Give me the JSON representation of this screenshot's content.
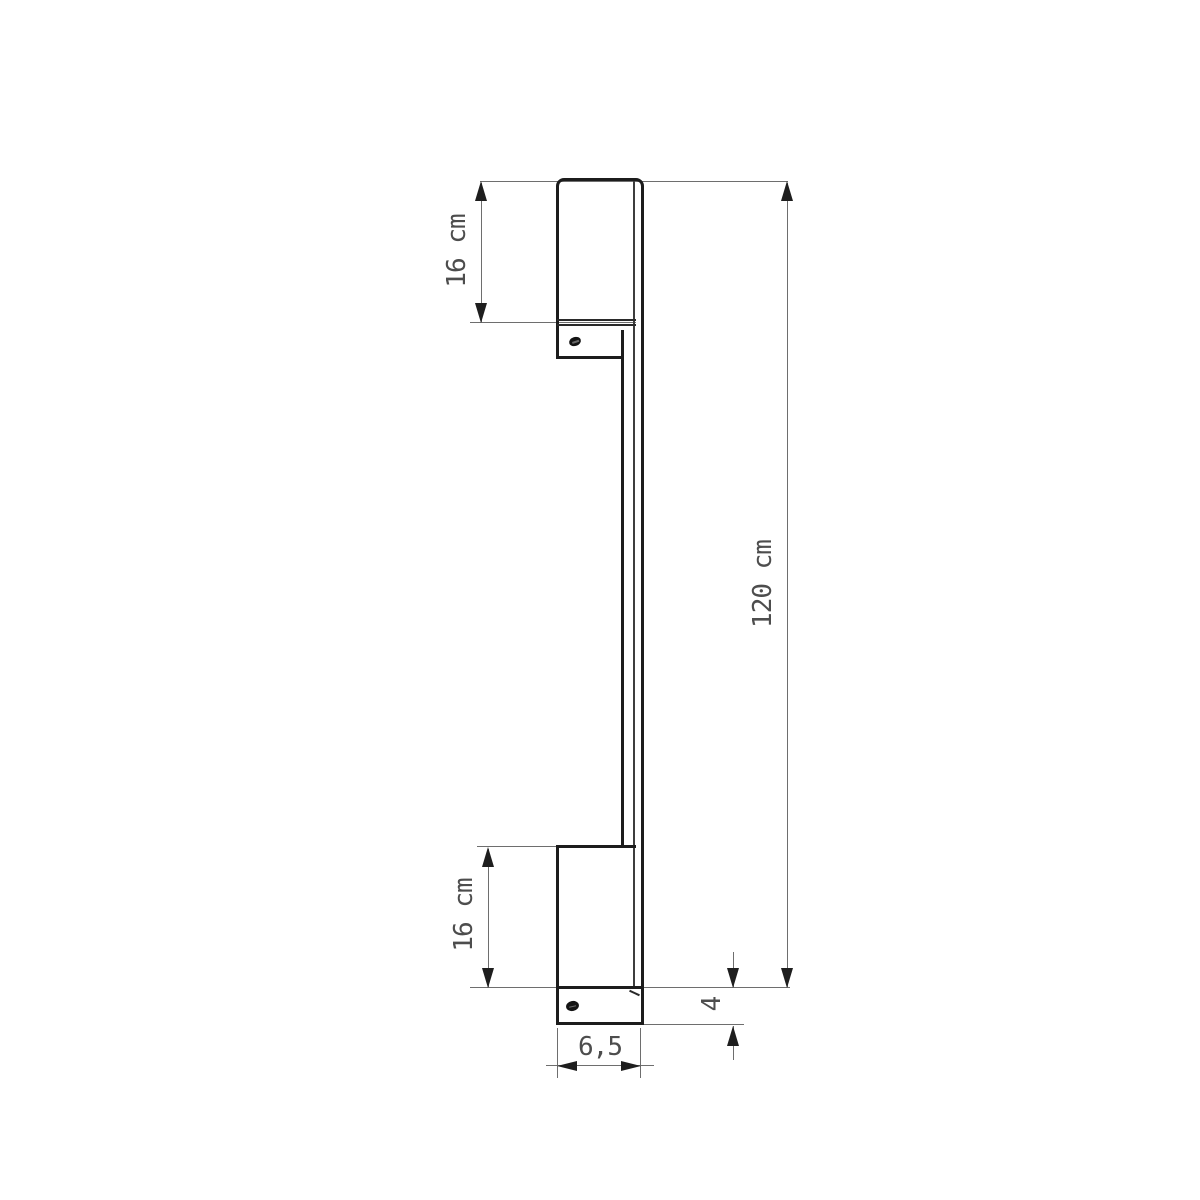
{
  "drawing": {
    "type": "technical-dimension-drawing",
    "view": "side-view-linear-wall-lamp",
    "labels": {
      "top_section": "16 cm",
      "overall_length": "120 cm",
      "bottom_section": "16 cm",
      "base_width": "6,5",
      "base_height": "4"
    },
    "values": {
      "top_section_cm": 16,
      "overall_length_cm": 120,
      "bottom_section_cm": 16,
      "base_width_cm": 6.5,
      "base_height_cm": 4
    },
    "colors": {
      "background": "#ffffff",
      "outline": "#1c1c1c",
      "dimension_line": "#6e6e6e",
      "arrow": "#1e1e1e",
      "label_text": "#4d4d4d"
    }
  }
}
